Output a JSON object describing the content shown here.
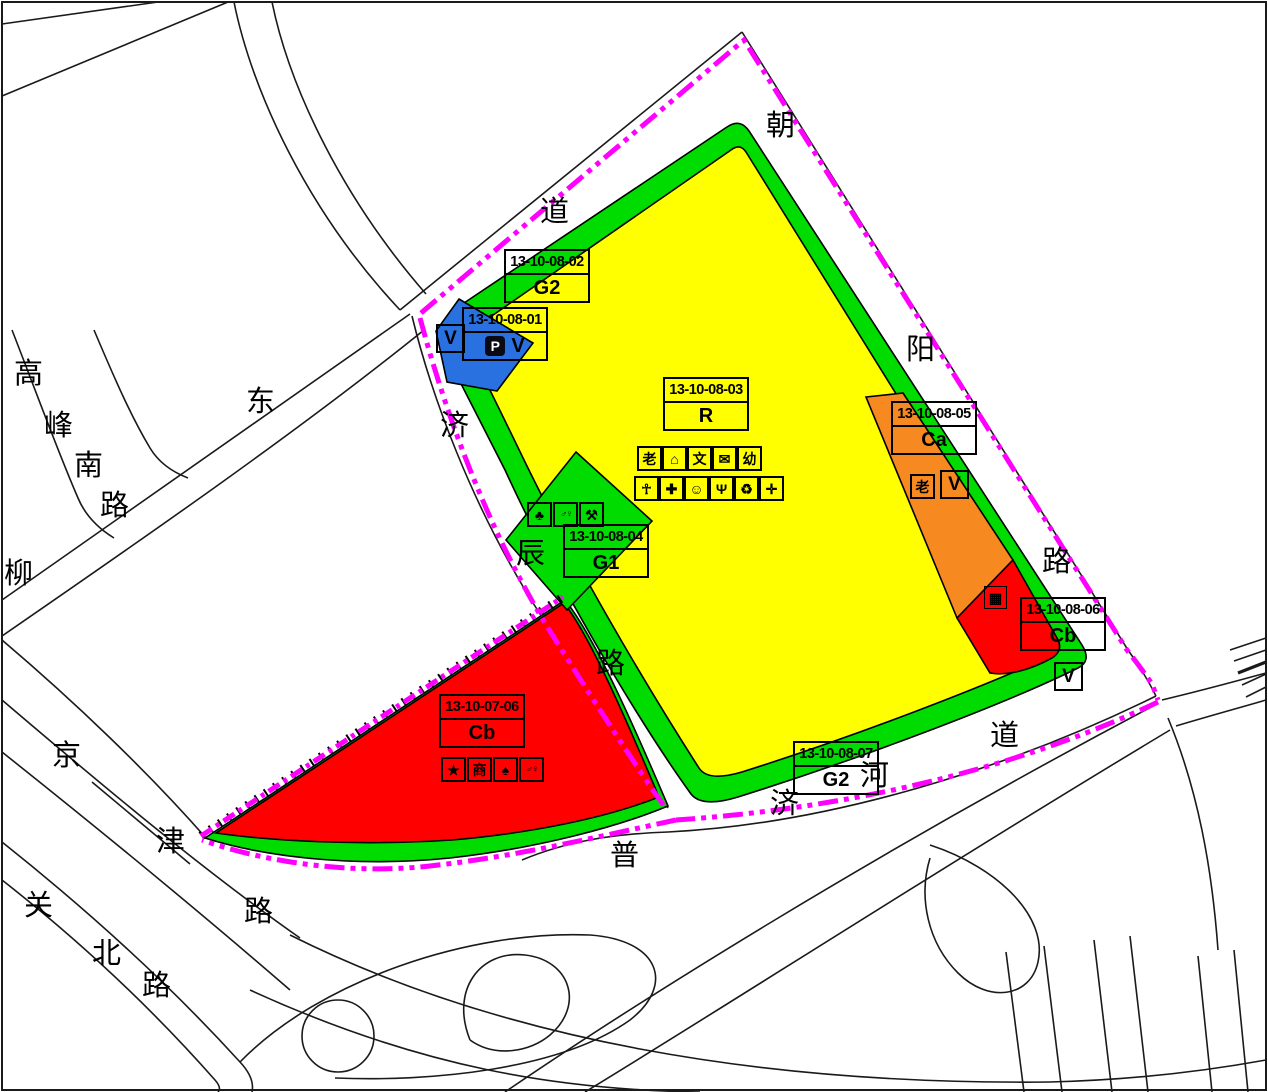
{
  "colors": {
    "boundary_magenta": "#FF00FF",
    "residential_yellow": "#FFFF00",
    "greenspace_green": "#00DC00",
    "commercial_red": "#FF0000",
    "commercial_orange": "#F6891F",
    "utility_blue": "#2970E0",
    "road_line_black": "#1A1A1A",
    "background": "#FFFFFF"
  },
  "parcels": {
    "p01": {
      "id": "13-10-08-01",
      "code": "V",
      "corner_label": "V",
      "parking_icon": "P"
    },
    "p02": {
      "id": "13-10-08-02",
      "code": "G2"
    },
    "p03": {
      "id": "13-10-08-03",
      "code": "R",
      "icons_row1": [
        {
          "name": "elderly-care",
          "glyph": "老"
        },
        {
          "name": "community-home",
          "glyph": "⌂"
        },
        {
          "name": "culture-station",
          "glyph": "文"
        },
        {
          "name": "post-office",
          "glyph": "✉"
        },
        {
          "name": "kindergarten",
          "glyph": "幼"
        }
      ],
      "icons_row2": [
        {
          "name": "sports-ground",
          "glyph": "☥"
        },
        {
          "name": "medical-clinic",
          "glyph": "✚"
        },
        {
          "name": "community-service",
          "glyph": "☺"
        },
        {
          "name": "restaurant",
          "glyph": "Ψ"
        },
        {
          "name": "waste-collection",
          "glyph": "♻"
        },
        {
          "name": "health-station",
          "glyph": "✛"
        }
      ]
    },
    "p04": {
      "id": "13-10-08-04",
      "code": "G1",
      "icons": [
        {
          "name": "park-pavilion",
          "glyph": "♣"
        },
        {
          "name": "public-toilet",
          "glyph": "♂♀"
        },
        {
          "name": "fitness",
          "glyph": "⚒"
        }
      ]
    },
    "p05": {
      "id": "13-10-08-05",
      "code": "Ca",
      "icons": [
        {
          "name": "elderly",
          "glyph": "老"
        },
        {
          "name": "v-utility",
          "glyph": "V"
        }
      ]
    },
    "p06": {
      "id": "13-10-08-06",
      "code": "Cb",
      "market_icon": "▦",
      "corner_label": "V"
    },
    "p07": {
      "id": "13-10-08-07",
      "code": "G2"
    },
    "p08": {
      "id": "13-10-07-06",
      "code": "Cb",
      "icons": [
        {
          "name": "star",
          "glyph": "★"
        },
        {
          "name": "commerce",
          "glyph": "商"
        },
        {
          "name": "security",
          "glyph": "♠"
        },
        {
          "name": "public-toilet",
          "glyph": "♂♀"
        }
      ]
    }
  },
  "roads": {
    "gaofengnan": {
      "name": "高峰南路",
      "chars": [
        "高",
        "峰",
        "南",
        "路"
      ]
    },
    "liu": {
      "name": "柳",
      "chars": [
        "柳"
      ]
    },
    "dong": {
      "name": "东",
      "chars": [
        "东"
      ]
    },
    "jichen": {
      "name": "济辰路",
      "chars": [
        "济",
        "辰",
        "路"
      ]
    },
    "chaoyang": {
      "name": "朝阳路",
      "chars": [
        "朝",
        "阳",
        "路"
      ]
    },
    "dao": {
      "name": "道",
      "chars": [
        "道"
      ]
    },
    "pujihedao": {
      "name": "普济河道",
      "chars": [
        "普",
        "济",
        "河",
        "道"
      ]
    },
    "jingjin": {
      "name": "京津路",
      "chars": [
        "京",
        "津",
        "路"
      ]
    },
    "guanbei": {
      "name": "关北路",
      "chars": [
        "关",
        "北",
        "路"
      ]
    }
  }
}
